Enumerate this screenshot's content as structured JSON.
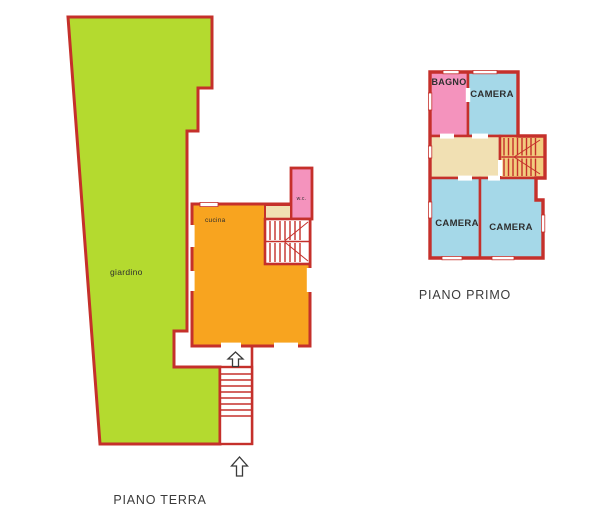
{
  "document": {
    "type": "floor-plan",
    "background": "#ffffff"
  },
  "colors": {
    "wall": "#c5302b",
    "garden": "#b4da2f",
    "kitchen_orange": "#f8a41f",
    "pink": "#f493bd",
    "bedroom_blue": "#a5d8e8",
    "corridor_beige": "#f1e0b3",
    "stairs_tan": "#f2cc7e",
    "label_text": "#3b3b3b"
  },
  "ground_floor": {
    "title": "PIANO TERRA",
    "garden_label": "giardino",
    "kitchen_label": "cucina",
    "wc_label": "w.c.",
    "entrance_arrows": 2
  },
  "first_floor": {
    "title": "PIANO PRIMO",
    "bathroom_label": "BAGNO",
    "bedroom_top_label": "CAMERA",
    "bedroom_bottom_left_label": "CAMERA",
    "bedroom_bottom_right_label": "CAMERA"
  }
}
